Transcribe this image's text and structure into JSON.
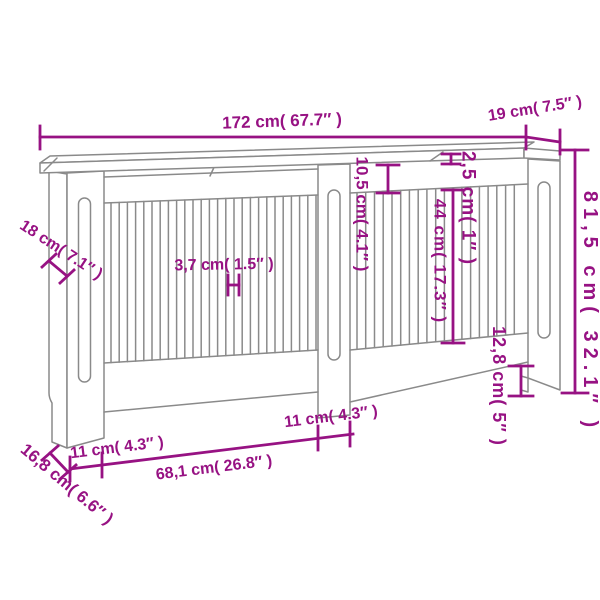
{
  "diagram": {
    "type": "technical-dimension-drawing",
    "subject": "radiator cover cabinet with vertical slats, front perspective view",
    "colors": {
      "dimension_annotation": "#971283",
      "drawing_lines": "#8A8A8A",
      "background": "#FFFFFF"
    },
    "dimensions": {
      "total_width": {
        "label": "172 cm( 67.7″ )",
        "cm": "172",
        "inches": "67.7"
      },
      "top_depth": {
        "label": "19 cm( 7.5″ )",
        "cm": "19",
        "inches": "7.5"
      },
      "total_height": {
        "label": "81,5 cm( 32.1″ )",
        "cm": "81,5",
        "inches": "32.1"
      },
      "top_board_thickness": {
        "label": "2,5 cm( 1″ )",
        "cm": "2,5",
        "inches": "1"
      },
      "top_rail_height": {
        "label": "10,5 cm( 4.1″ )",
        "cm": "10,5",
        "inches": "4.1"
      },
      "slat_length": {
        "label": "44 cm( 17.3″ )",
        "cm": "44",
        "inches": "17.3"
      },
      "bottom_rail_height": {
        "label": "12,8 cm( 5″ )",
        "cm": "12,8",
        "inches": "5"
      },
      "side_panel_depth": {
        "label": "18 cm( 7.1″ )",
        "cm": "18",
        "inches": "7.1"
      },
      "slat_width": {
        "label": "3,7 cm( 1.5″ )",
        "cm": "3,7",
        "inches": "1.5"
      },
      "base_depth": {
        "label": "16,8 cm( 6.6″ )",
        "cm": "16,8",
        "inches": "6.6"
      },
      "left_stile_width": {
        "label": "11 cm( 4.3″ )",
        "cm": "11",
        "inches": "4.3"
      },
      "left_panel_width": {
        "label": "68,1 cm( 26.8″ )",
        "cm": "68,1",
        "inches": "26.8"
      },
      "middle_stile_width": {
        "label": "11 cm( 4.3″ )",
        "cm": "11",
        "inches": "4.3"
      }
    }
  }
}
